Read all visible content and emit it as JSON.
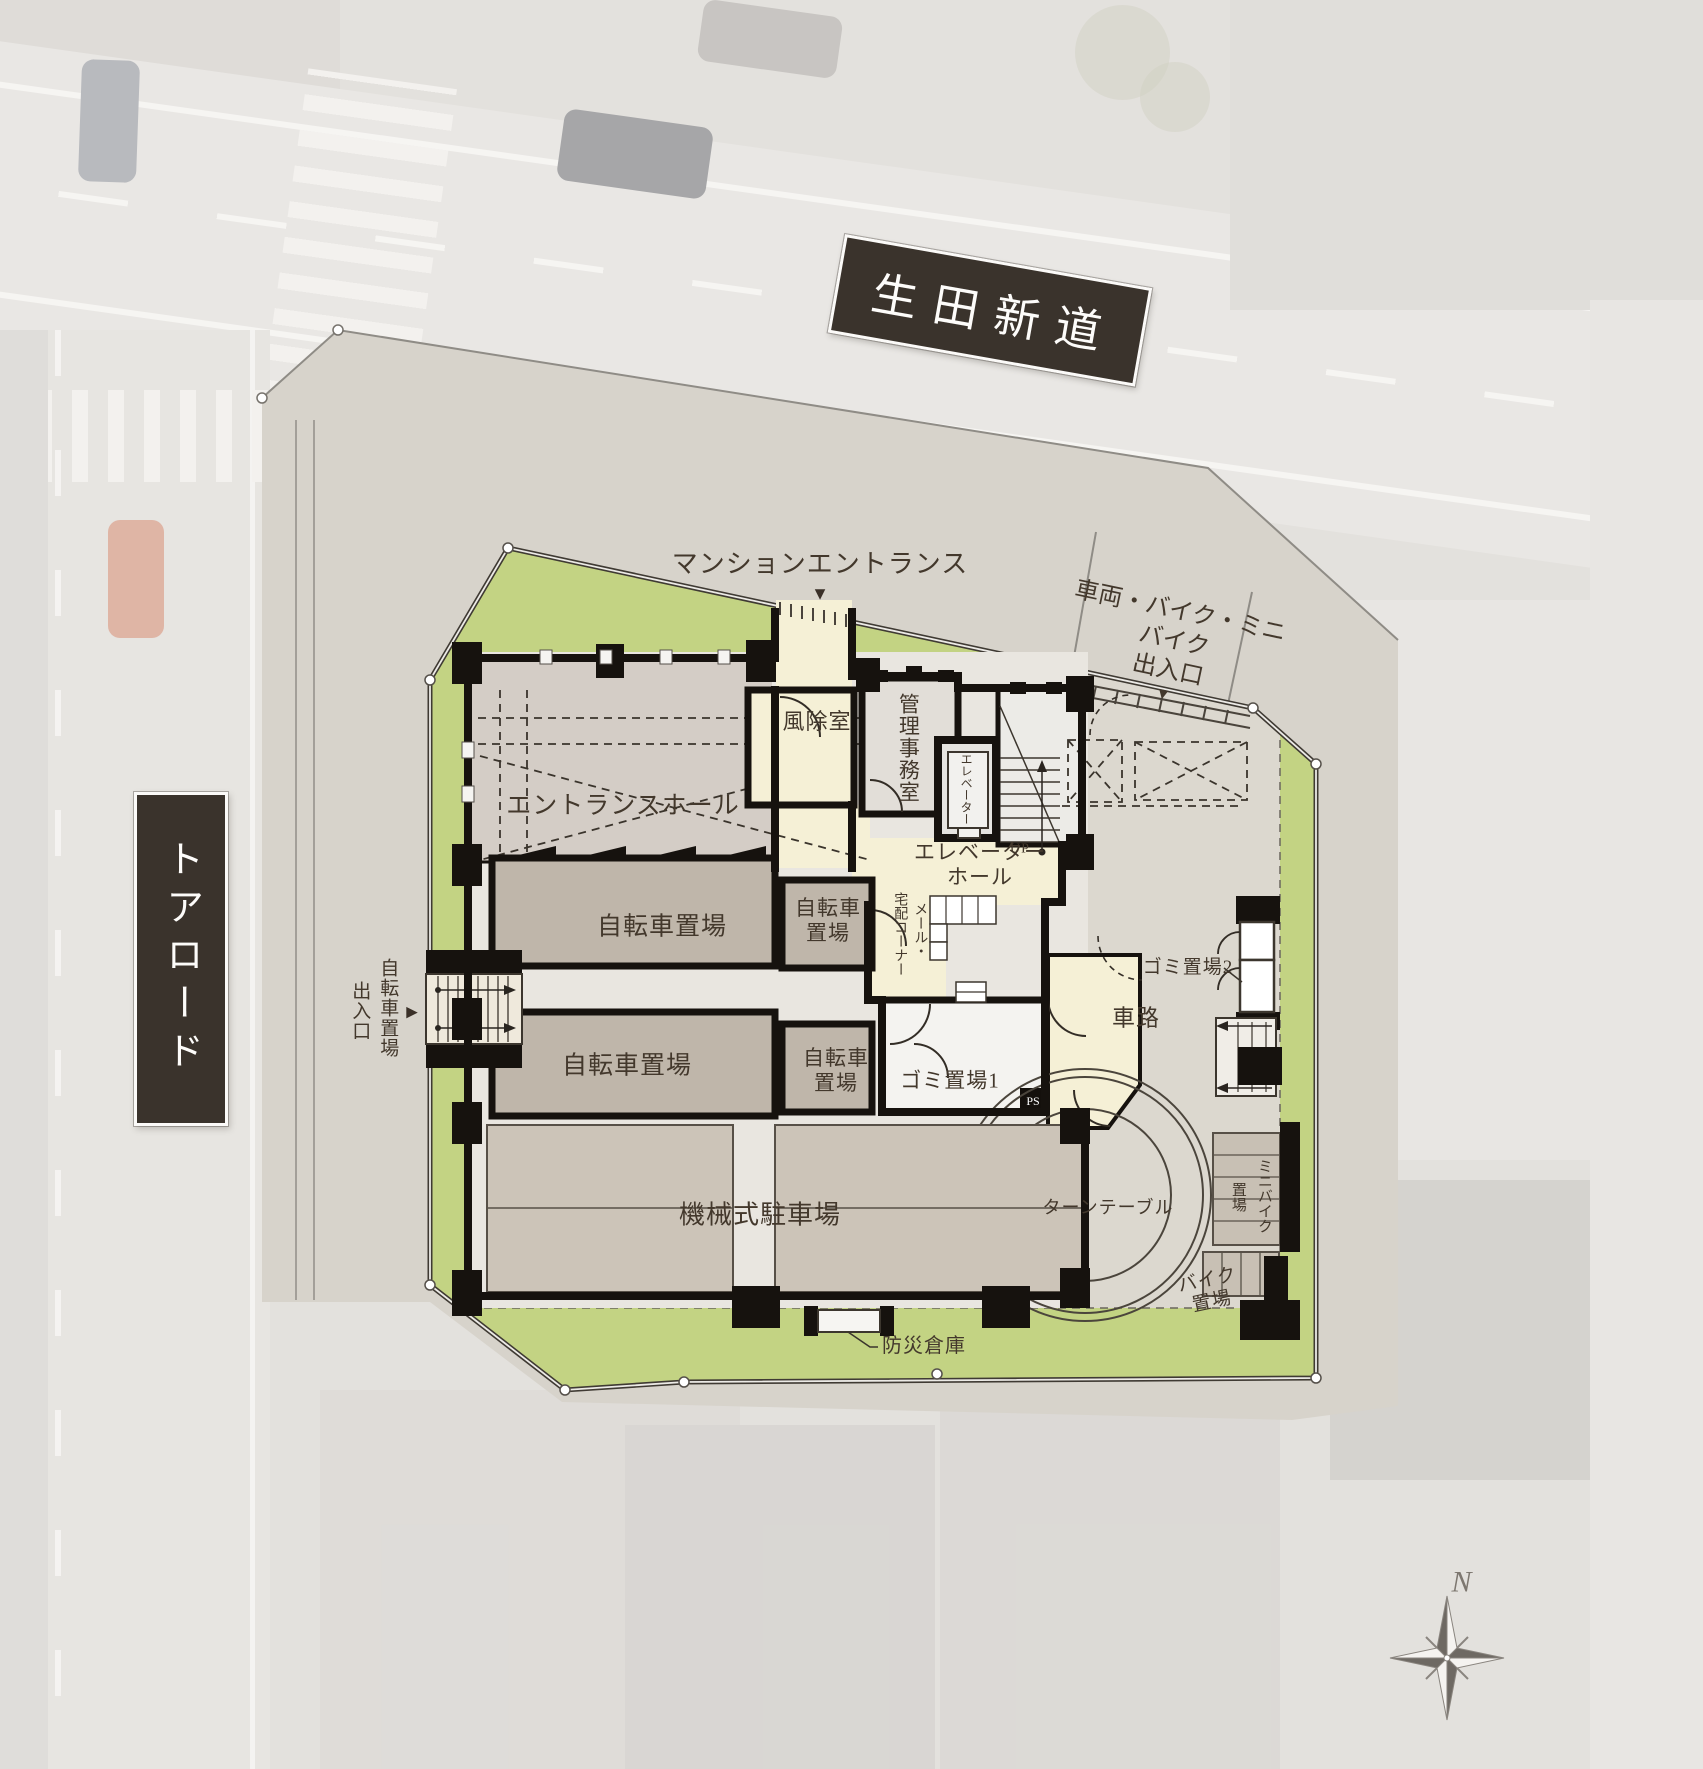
{
  "signs": {
    "road_top": "生田新道",
    "road_left": "トアロード"
  },
  "markers": {
    "down": "▼",
    "right": "▶"
  },
  "annotations": {
    "mansion_entrance": "マンションエントランス",
    "vehicle_entrance": "車両・バイク・ミニバイク",
    "deiriguchi": "出入口",
    "bicycle_entrance": "自転車置場"
  },
  "rooms": {
    "windbreak": "風除室",
    "management_office": "管理事務室",
    "elevator": "エレベーター",
    "entrance_hall": "エントランスホール",
    "elevator_hall_line1": "エレベーター",
    "elevator_hall_line2": "ホール",
    "mail_line1": "メール・",
    "mail_line2": "宅配コーナー",
    "bicycle_parking": "自転車置場",
    "garbage1": "ゴミ置場1",
    "garbage2": "ゴミ置場2",
    "driveway": "車路",
    "turntable": "ターンテーブル",
    "minibike_line1": "ミニバイク",
    "minibike_line2": "置場",
    "bike_line1": "バイク",
    "bike_line2": "置場",
    "mechanical_parking": "機械式駐車場",
    "disaster_storage": "防災倉庫",
    "up": "UP",
    "ps": "PS"
  },
  "compass": {
    "north": "N"
  },
  "colors": {
    "green": "#c3d383",
    "cream": "#f5f0d6",
    "room_taupe": "#bfb6aa",
    "platform": "#ccc4b8",
    "sign_bg": "#3a332c",
    "wall": "#16120e"
  }
}
